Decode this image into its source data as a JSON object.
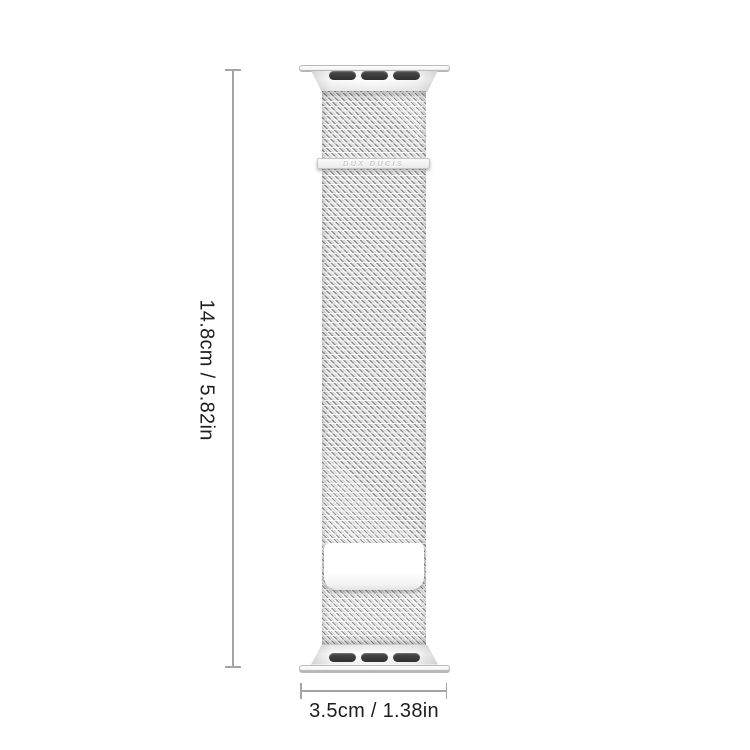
{
  "product": {
    "type_label": "milanese-loop-watch-band",
    "brand_logo_text": "DUX DUCIS"
  },
  "dimensions": {
    "height_label": "14.8cm / 5.82in",
    "width_label": "3.5cm / 1.38in"
  },
  "colors": {
    "background": "#ffffff",
    "dimension_line": "#a5a5a5",
    "label_text": "#1e1e1e",
    "band_thread_silver": "#8c8c8c",
    "connector_slot_dark": "#3a3a3a",
    "logo_text_gray": "#c9c9c9"
  }
}
